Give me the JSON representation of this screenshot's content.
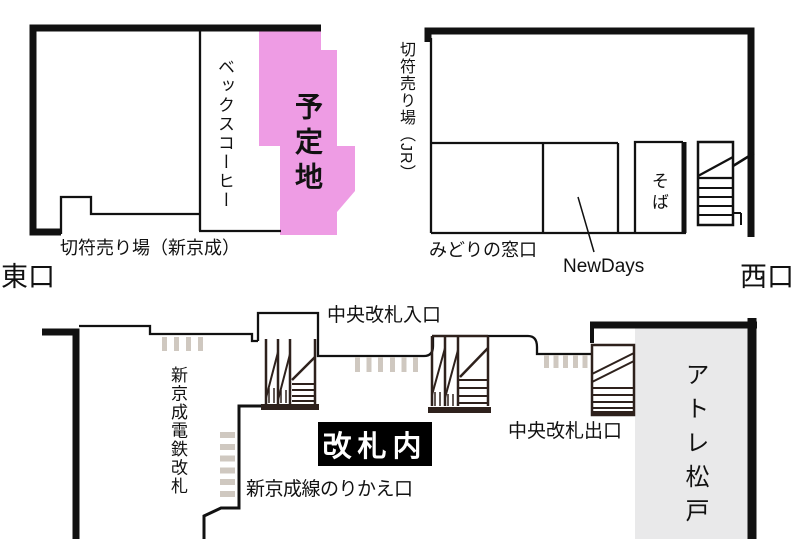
{
  "colors": {
    "planned_site": "#ee9ce4",
    "atre_fill": "#e9e9ea",
    "gate_bar": "#cfc8c0",
    "stairs": "#2e211c",
    "wall": "#111111"
  },
  "east_wing": {
    "becks_coffee_label": "ベックスコーヒー",
    "planned_site_label": "予定地",
    "ticket_office_label": "切符売り場（新京成）",
    "east_exit_label": "東口"
  },
  "west_wing": {
    "ticket_office_jr_label": "切符売り場（JR）",
    "midori_window_label": "みどりの窓口",
    "newdays_label": "NewDays",
    "soba_label": "そば",
    "west_exit_label": "西口"
  },
  "concourse": {
    "central_gate_entrance_label": "中央改札入口",
    "shinkeisei_railway_gate_label": "新京成電鉄改札",
    "inside_gates_label": "改札内",
    "central_gate_exit_label": "中央改札出口",
    "shinkeisei_transfer_label": "新京成線のりかえ口",
    "atre_matsudo_label": "アトレ松戸"
  }
}
